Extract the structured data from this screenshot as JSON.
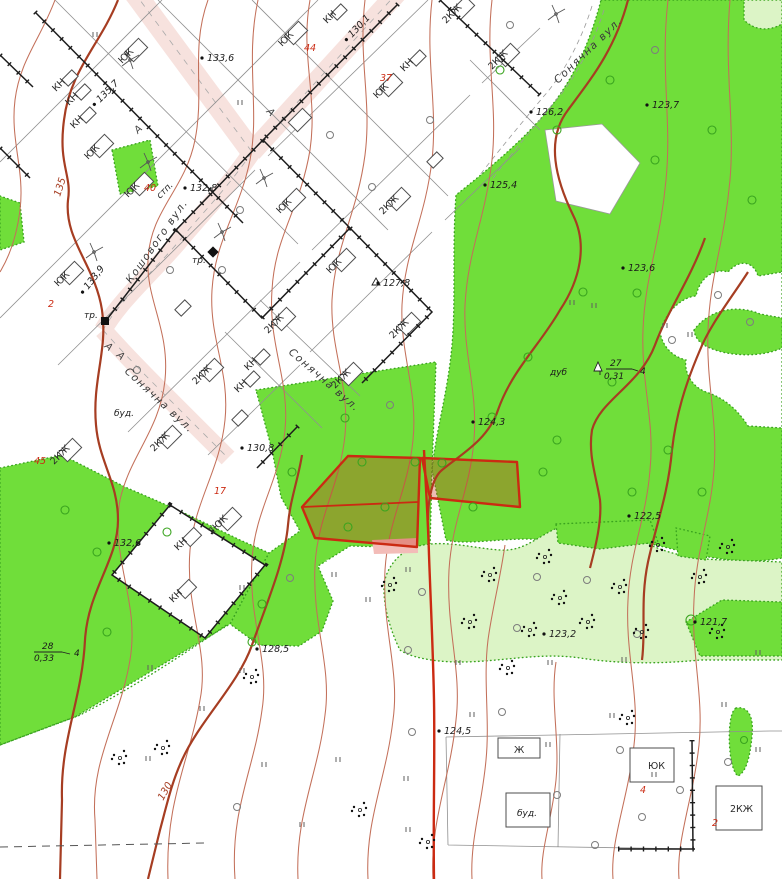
{
  "map": {
    "kind": "topographic cadastral plan",
    "width_px": 782,
    "height_px": 879
  },
  "colors": {
    "forest_green": "#70de3a",
    "shrub_green": "#dcf4c6",
    "road_pink": "#f7e2de",
    "contour_brown": "#c3705a",
    "index_contour": "#a63d22",
    "cadastral_red": "#cb2a12",
    "parcel_overlay": "rgba(199,48,22,0.32)",
    "pink_patch": "#f3bcb8",
    "grid_black": "#1c1c1c",
    "tree_green": "#3aa41f"
  },
  "labels": {
    "streets": [
      {
        "text": "Кошового вул.",
        "x": 131,
        "y": 284,
        "rotate": -55
      },
      {
        "text": "Сонячна вул.",
        "x": 124,
        "y": 372,
        "rotate": 43
      },
      {
        "text": "Сонячна вул.",
        "x": 288,
        "y": 353,
        "rotate": 41
      },
      {
        "text": "Сонячна вул.",
        "x": 558,
        "y": 84,
        "rotate": -44
      }
    ],
    "elevations": [
      {
        "text": "135,7",
        "x": 100,
        "y": 103,
        "rotate": -45
      },
      {
        "text": "133,6",
        "x": 207,
        "y": 61
      },
      {
        "text": "130,1",
        "x": 352,
        "y": 38,
        "rotate": -47
      },
      {
        "text": "132,8",
        "x": 190,
        "y": 191
      },
      {
        "text": "126,2",
        "x": 536,
        "y": 115
      },
      {
        "text": "123,7",
        "x": 652,
        "y": 108
      },
      {
        "text": "125,4",
        "x": 490,
        "y": 188
      },
      {
        "text": "123,6",
        "x": 628,
        "y": 271
      },
      {
        "text": "133,9",
        "x": 88,
        "y": 290,
        "rotate": -52
      },
      {
        "text": "127,8",
        "x": 383,
        "y": 286
      },
      {
        "text": "124,3",
        "x": 478,
        "y": 425
      },
      {
        "text": "130,8",
        "x": 247,
        "y": 451
      },
      {
        "text": "122,5",
        "x": 634,
        "y": 519
      },
      {
        "text": "132,6",
        "x": 114,
        "y": 546
      },
      {
        "text": "128,5",
        "x": 262,
        "y": 652
      },
      {
        "text": "123,2",
        "x": 549,
        "y": 637
      },
      {
        "text": "121,7",
        "x": 700,
        "y": 625
      },
      {
        "text": "124,5",
        "x": 444,
        "y": 734
      }
    ],
    "buildings": [
      {
        "text": "ЮК",
        "x": 122,
        "y": 64,
        "rotate": -45
      },
      {
        "text": "ЮК",
        "x": 88,
        "y": 160,
        "rotate": -45
      },
      {
        "text": "ЮК",
        "x": 128,
        "y": 198,
        "rotate": -45
      },
      {
        "text": "ЮК",
        "x": 282,
        "y": 47,
        "rotate": -45
      },
      {
        "text": "ЮК",
        "x": 377,
        "y": 99,
        "rotate": -45
      },
      {
        "text": "ЮК",
        "x": 280,
        "y": 214,
        "rotate": -45
      },
      {
        "text": "ЮК",
        "x": 330,
        "y": 274,
        "rotate": -45
      },
      {
        "text": "ЮК",
        "x": 58,
        "y": 287,
        "rotate": -45
      },
      {
        "text": "ЮК",
        "x": 648,
        "y": 769
      },
      {
        "text": "КН",
        "x": 56,
        "y": 92,
        "rotate": -45
      },
      {
        "text": "КН",
        "x": 69,
        "y": 106,
        "rotate": -45
      },
      {
        "text": "КН",
        "x": 74,
        "y": 129,
        "rotate": -45
      },
      {
        "text": "КН",
        "x": 327,
        "y": 24,
        "rotate": -45
      },
      {
        "text": "КН",
        "x": 404,
        "y": 72,
        "rotate": -45
      },
      {
        "text": "КН",
        "x": 248,
        "y": 371,
        "rotate": -45
      },
      {
        "text": "КН",
        "x": 238,
        "y": 393,
        "rotate": -45
      },
      {
        "text": "КН",
        "x": 178,
        "y": 551,
        "rotate": -45
      },
      {
        "text": "КН",
        "x": 173,
        "y": 603,
        "rotate": -45
      },
      {
        "text": "2КЖ",
        "x": 446,
        "y": 24,
        "rotate": -45
      },
      {
        "text": "2КЖ",
        "x": 492,
        "y": 70,
        "rotate": -45
      },
      {
        "text": "2КЖ",
        "x": 383,
        "y": 215,
        "rotate": -45
      },
      {
        "text": "2КЖ",
        "x": 268,
        "y": 334,
        "rotate": -45
      },
      {
        "text": "2КЖ",
        "x": 393,
        "y": 339,
        "rotate": -45
      },
      {
        "text": "2КЖ",
        "x": 335,
        "y": 389,
        "rotate": -45
      },
      {
        "text": "2КЖ",
        "x": 196,
        "y": 385,
        "rotate": -45
      },
      {
        "text": "2КЖ",
        "x": 154,
        "y": 452,
        "rotate": -45
      },
      {
        "text": "2КЖ",
        "x": 54,
        "y": 465,
        "rotate": -45
      },
      {
        "text": "2КЖ",
        "x": 730,
        "y": 812
      },
      {
        "text": "2ЮК",
        "x": 212,
        "y": 535,
        "rotate": -45
      },
      {
        "text": "Ж",
        "x": 514,
        "y": 753
      }
    ],
    "plot_numbers": [
      {
        "text": "44",
        "x": 304,
        "y": 51
      },
      {
        "text": "37",
        "x": 380,
        "y": 81
      },
      {
        "text": "40",
        "x": 144,
        "y": 191
      },
      {
        "text": "2",
        "x": 48,
        "y": 307
      },
      {
        "text": "45",
        "x": 34,
        "y": 464
      },
      {
        "text": "17",
        "x": 214,
        "y": 494
      },
      {
        "text": "4",
        "x": 640,
        "y": 793
      },
      {
        "text": "2",
        "x": 712,
        "y": 826
      }
    ],
    "contours": [
      {
        "text": "135",
        "x": 60,
        "y": 197,
        "rotate": -72
      },
      {
        "text": "130",
        "x": 163,
        "y": 801,
        "rotate": -60
      }
    ],
    "forest": [
      {
        "text": "28",
        "x": 42,
        "y": 649
      },
      {
        "text": "0,33",
        "x": 34,
        "y": 661
      },
      {
        "text": "4",
        "x": 74,
        "y": 656
      },
      {
        "text": "дуб",
        "x": 550,
        "y": 375
      },
      {
        "text": "27",
        "x": 610,
        "y": 366
      },
      {
        "text": "0,31",
        "x": 604,
        "y": 379
      },
      {
        "text": "4",
        "x": 640,
        "y": 374
      }
    ],
    "road_letters": [
      {
        "text": "А",
        "x": 138,
        "y": 134,
        "rotate": -45
      },
      {
        "text": "А",
        "x": 266,
        "y": 112,
        "rotate": 45
      },
      {
        "text": "А",
        "x": 104,
        "y": 347,
        "rotate": 40
      },
      {
        "text": "А",
        "x": 116,
        "y": 356,
        "rotate": 40
      }
    ],
    "misc": [
      {
        "text": "тр.",
        "x": 192,
        "y": 263
      },
      {
        "text": "тр.",
        "x": 84,
        "y": 318
      },
      {
        "text": "стп.",
        "x": 160,
        "y": 199,
        "rotate": -45
      },
      {
        "text": "буд.",
        "x": 114,
        "y": 416
      },
      {
        "text": "буд.",
        "x": 517,
        "y": 816
      }
    ]
  }
}
